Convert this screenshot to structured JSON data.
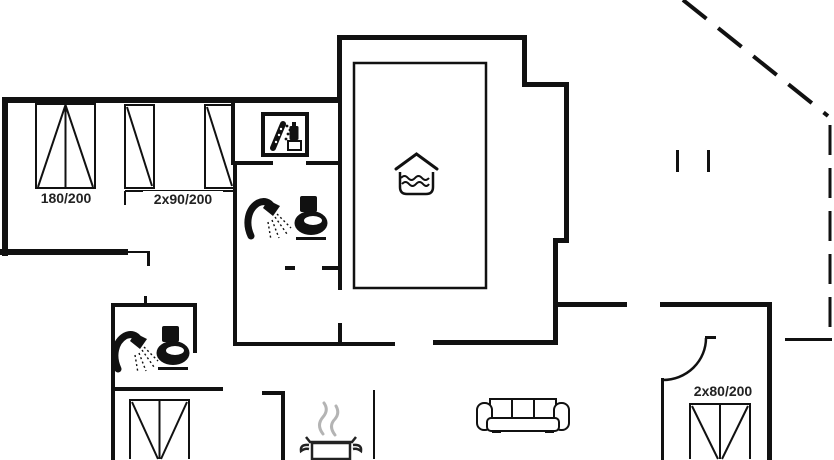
{
  "floorplan": {
    "background_color": "#ffffff",
    "wall_color": "#111111",
    "steam_color": "#b4b4b4",
    "labels": {
      "bed_180": "180/200",
      "bed_2x90": "2x90/200",
      "bed_2x80": "2x80/200"
    },
    "icons": {
      "washing_machine": "washing-machine-icon",
      "shower": "shower-icon",
      "toilet": "toilet-icon",
      "hot_tub": "hot-tub-icon",
      "sofa": "sofa-icon",
      "cooking_pot": "cooking-pot-icon",
      "steam": "steam-icon",
      "door_swing": "door-swing-arc",
      "terrace_boundary": "terrace-dashed-line"
    }
  }
}
